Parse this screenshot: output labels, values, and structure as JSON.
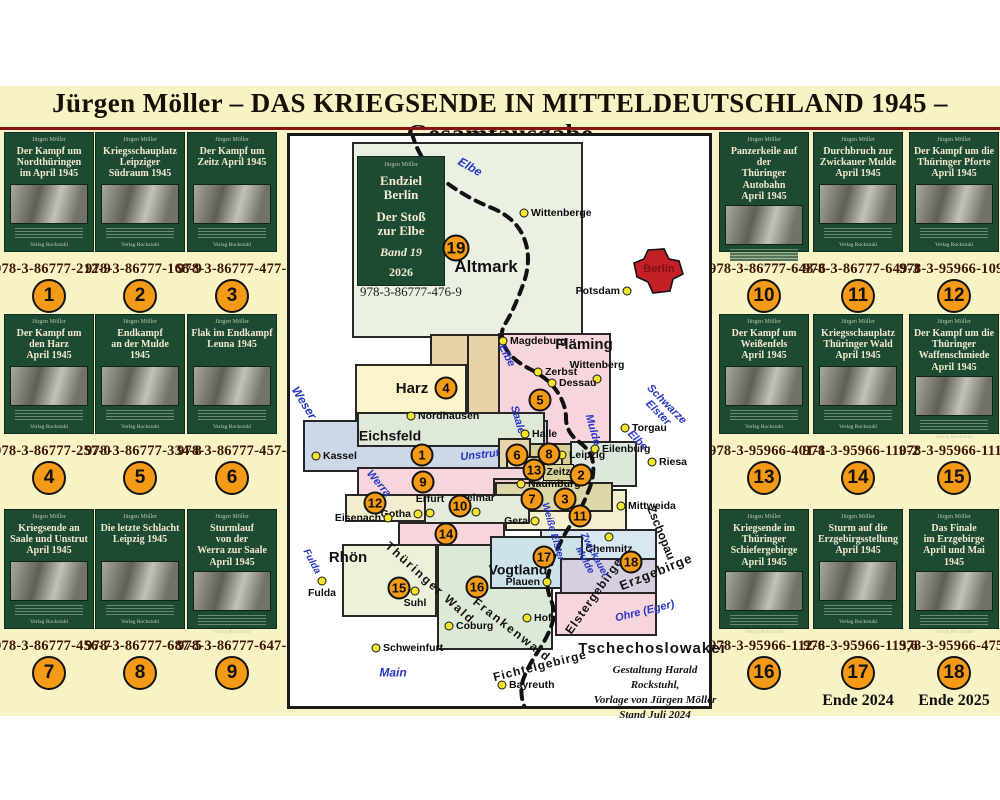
{
  "title": "Jürgen Möller – DAS KRIEGSENDE IN  MITTELDEUTSCHLAND 1945 – Gesamtausgabe",
  "author": "Jürgen Möller",
  "publisher": "Verlag Rockstuhl",
  "books_left": [
    {
      "num": "1",
      "title": "Der Kampf um\nNordthüringen\nim April 1945",
      "isbn": "978-3-86777-212-9"
    },
    {
      "num": "2",
      "title": "Kriegsschauplatz\nLeipziger\nSüdraum 1945",
      "isbn": "978-3-86777-168-9"
    },
    {
      "num": "3",
      "title": "Der Kampf um\nZeitz April 1945",
      "isbn": "978-3-86777-477-2"
    },
    {
      "num": "4",
      "title": "Der Kampf um\nden Harz\nApril 1945",
      "isbn": "978-3-86777-257-0"
    },
    {
      "num": "5",
      "title": "Endkampf\nan der Mulde\n1945",
      "isbn": "978-3-86777-334-8"
    },
    {
      "num": "6",
      "title": "Flak im Endkampf\nLeuna 1945",
      "isbn": "978-3-86777-457-4"
    },
    {
      "num": "7",
      "title": "Kriegsende an\nSaale und Unstrut\nApril 1945",
      "isbn": "978-3-86777-456-7"
    },
    {
      "num": "8",
      "title": "Die letzte Schlacht\nLeipzig 1945",
      "isbn": "978-3-86777-687-5"
    },
    {
      "num": "9",
      "title": "Sturmlauf\nvon der\nWerra zur Saale\nApril 1945",
      "isbn": "978-3-86777-647-9"
    }
  ],
  "books_right": [
    {
      "num": "10",
      "title": "Panzerkeile auf der\nThüringer Autobahn\nApril 1945",
      "isbn": "978-3-86777-648-6"
    },
    {
      "num": "11",
      "title": "Durchbruch zur\nZwickauer Mulde\nApril 1945",
      "isbn": "978-3-86777-649-3"
    },
    {
      "num": "12",
      "title": "Der Kampf um die\nThüringer Pforte\nApril 1945",
      "isbn": "978-3-95966-109-6"
    },
    {
      "num": "13",
      "title": "Der Kampf um\nWeißenfels\nApril 1945",
      "isbn": "978-3-95966-401-1"
    },
    {
      "num": "14",
      "title": "Kriegsschauplatz\nThüringer Wald\nApril 1945",
      "isbn": "978-3-95966-110-2"
    },
    {
      "num": "15",
      "title": "Der Kampf um die\nThüringer\nWaffenschmiede\nApril 1945",
      "isbn": "978-3-95966-111-9"
    },
    {
      "num": "16",
      "title": "Kriegsende im\nThüringer Schiefergebirge\nApril 1945",
      "isbn": "978-3-95966-112-6"
    },
    {
      "num": "17",
      "title": "Sturm auf die\nErzgebirgsstellung\nApril 1945",
      "isbn": "978-3-95966-113,6",
      "note": "Ende 2024"
    },
    {
      "num": "18",
      "title": "Das Finale\nim Erzgebirge\nApril und Mai 1945",
      "isbn": "978-3-95966-475-2",
      "note": "Ende 2025"
    }
  ],
  "band19": {
    "num": "19",
    "author": "Jürgen Möller",
    "line1": "Endziel\nBerlin",
    "line2": "Der Stoß\nzur Elbe",
    "line3": "Band 19",
    "line4": "2026",
    "isbn": "978-3-86777-476-9"
  },
  "map": {
    "credit": "Gestaltung Harald Rockstuhl,\nVorlage von Jürgen Möller\nStand Juli 2024",
    "berlin_label": "Berlin",
    "zeitz_box": {
      "text": "Zeitz",
      "x": 543,
      "y": 464,
      "w": 31,
      "h": 17
    },
    "boxes": [
      [
        352,
        142,
        231,
        196,
        "#eaf0e2"
      ],
      [
        430,
        334,
        153,
        32,
        "#e9d2a8"
      ],
      [
        467,
        334,
        40,
        103,
        "#e9d2a8"
      ],
      [
        498,
        333,
        113,
        114,
        "#f7d5dc"
      ],
      [
        355,
        364,
        112,
        73,
        "#fcf5cc"
      ],
      [
        303,
        420,
        245,
        52,
        "#ccd8e8"
      ],
      [
        357,
        412,
        188,
        35,
        "#dfe9d8"
      ],
      [
        528,
        443,
        84,
        44,
        "#d6d096"
      ],
      [
        570,
        441,
        67,
        46,
        "#dce8dc"
      ],
      [
        498,
        438,
        33,
        52,
        "#e6d5ac"
      ],
      [
        506,
        456,
        57,
        32,
        "#e9ddb9"
      ],
      [
        357,
        467,
        173,
        31,
        "#f7d5dc"
      ],
      [
        505,
        489,
        122,
        42,
        "#f4efcf"
      ],
      [
        493,
        478,
        40,
        34,
        "#f0c9cd"
      ],
      [
        495,
        482,
        118,
        30,
        "#ddd6a8"
      ],
      [
        345,
        494,
        87,
        28,
        "#f2edcf"
      ],
      [
        424,
        494,
        106,
        30,
        "#e3ecdb"
      ],
      [
        398,
        522,
        107,
        29,
        "#f7d5dc"
      ],
      [
        342,
        544,
        95,
        73,
        "#ecf2da"
      ],
      [
        437,
        544,
        116,
        106,
        "#dbe9d6"
      ],
      [
        540,
        529,
        117,
        31,
        "#d8e8f2"
      ],
      [
        490,
        536,
        93,
        53,
        "#cee2e9"
      ],
      [
        560,
        558,
        97,
        36,
        "#d5cfe1"
      ],
      [
        555,
        592,
        102,
        44,
        "#f7d5dc"
      ]
    ],
    "labels": [
      {
        "t": "Altmark",
        "x": 486,
        "y": 267,
        "s": 17,
        "r": 0
      },
      {
        "t": "Fläming",
        "x": 584,
        "y": 345,
        "s": 15,
        "r": 0
      },
      {
        "t": "Harz",
        "x": 412,
        "y": 389,
        "s": 15,
        "r": 0
      },
      {
        "t": "Eichsfeld",
        "x": 390,
        "y": 436,
        "s": 14,
        "r": 0
      },
      {
        "t": "Rhön",
        "x": 348,
        "y": 558,
        "s": 15,
        "r": 0
      },
      {
        "t": "Vogtland",
        "x": 518,
        "y": 570,
        "s": 14,
        "r": 0
      },
      {
        "t": "Thüringer Wald",
        "x": 430,
        "y": 583,
        "s": 12,
        "r": 42,
        "ls": 2
      },
      {
        "t": "Frankenwald",
        "x": 512,
        "y": 630,
        "s": 12,
        "r": 38,
        "ls": 2
      },
      {
        "t": "Fichtelgebirge",
        "x": 540,
        "y": 666,
        "s": 12,
        "r": -14,
        "ls": 1
      },
      {
        "t": "Elstergebirge",
        "x": 594,
        "y": 596,
        "s": 12,
        "r": -55,
        "ls": 1
      },
      {
        "t": "Erzgebirge",
        "x": 656,
        "y": 572,
        "s": 13,
        "r": -22,
        "ls": 1
      },
      {
        "t": "Zschopau",
        "x": 661,
        "y": 533,
        "s": 12,
        "r": 68
      },
      {
        "t": "Tschechoslowakei",
        "x": 652,
        "y": 649,
        "s": 15,
        "r": 0,
        "ls": 1
      }
    ],
    "rivers": [
      {
        "t": "Elbe",
        "x": 470,
        "y": 167,
        "s": 12,
        "r": 30
      },
      {
        "t": "Elbe",
        "x": 506,
        "y": 356,
        "s": 11,
        "r": 62
      },
      {
        "t": "Elbe",
        "x": 637,
        "y": 441,
        "s": 11,
        "r": 45
      },
      {
        "t": "Weser",
        "x": 304,
        "y": 403,
        "s": 12,
        "r": 58
      },
      {
        "t": "Saale",
        "x": 517,
        "y": 420,
        "s": 11,
        "r": 74
      },
      {
        "t": "Unstrut",
        "x": 480,
        "y": 456,
        "s": 11,
        "r": -6
      },
      {
        "t": "Werra",
        "x": 378,
        "y": 484,
        "s": 11,
        "r": 50
      },
      {
        "t": "Mulde",
        "x": 592,
        "y": 430,
        "s": 11,
        "r": 74
      },
      {
        "t": "Schwarze\nElster",
        "x": 662,
        "y": 409,
        "s": 11,
        "r": 45
      },
      {
        "t": "Weiße Elster",
        "x": 552,
        "y": 532,
        "s": 10,
        "r": 74
      },
      {
        "t": "Zwickauer\nMulde",
        "x": 589,
        "y": 558,
        "s": 10,
        "r": 62
      },
      {
        "t": "Ohre (Eger)",
        "x": 645,
        "y": 612,
        "s": 11,
        "r": -14
      },
      {
        "t": "Main",
        "x": 393,
        "y": 673,
        "s": 12,
        "r": 0
      },
      {
        "t": "Fulda",
        "x": 311,
        "y": 562,
        "s": 10,
        "r": 62
      }
    ],
    "cities": [
      {
        "n": "Wittenberge",
        "x": 524,
        "y": 213,
        "side": "right"
      },
      {
        "n": "Potsdam",
        "x": 627,
        "y": 291,
        "side": "left"
      },
      {
        "n": "Magdeburg",
        "x": 503,
        "y": 341,
        "side": "right"
      },
      {
        "n": "Zerbst",
        "x": 538,
        "y": 372,
        "side": "right"
      },
      {
        "n": "Wittenberg",
        "x": 597,
        "y": 379,
        "side": "above"
      },
      {
        "n": "Dessau",
        "x": 552,
        "y": 383,
        "side": "right"
      },
      {
        "n": "Nordhausen",
        "x": 411,
        "y": 416,
        "side": "right"
      },
      {
        "n": "Halle",
        "x": 525,
        "y": 434,
        "side": "right"
      },
      {
        "n": "Kassel",
        "x": 316,
        "y": 456,
        "side": "right"
      },
      {
        "n": "Torgau",
        "x": 625,
        "y": 428,
        "side": "right"
      },
      {
        "n": "Eilenburg",
        "x": 595,
        "y": 449,
        "side": "right"
      },
      {
        "n": "Riesa",
        "x": 652,
        "y": 462,
        "side": "right"
      },
      {
        "n": "Leipzig",
        "x": 562,
        "y": 455,
        "side": "right"
      },
      {
        "n": "Naumburg",
        "x": 521,
        "y": 484,
        "side": "right"
      },
      {
        "n": "Weimar",
        "x": 476,
        "y": 512,
        "side": "above"
      },
      {
        "n": "Erfurt",
        "x": 430,
        "y": 513,
        "side": "above"
      },
      {
        "n": "Gotha",
        "x": 418,
        "y": 514,
        "side": "left"
      },
      {
        "n": "Eisenach",
        "x": 388,
        "y": 518,
        "side": "left"
      },
      {
        "n": "Gera",
        "x": 535,
        "y": 521,
        "side": "left"
      },
      {
        "n": "Mittweida",
        "x": 621,
        "y": 506,
        "side": "right"
      },
      {
        "n": "Chemnitz",
        "x": 609,
        "y": 537,
        "side": "below"
      },
      {
        "n": "Plauen",
        "x": 547,
        "y": 582,
        "side": "left"
      },
      {
        "n": "Suhl",
        "x": 415,
        "y": 591,
        "side": "below"
      },
      {
        "n": "Hof",
        "x": 527,
        "y": 618,
        "side": "right"
      },
      {
        "n": "Coburg",
        "x": 449,
        "y": 626,
        "side": "right"
      },
      {
        "n": "Schweinfurt",
        "x": 376,
        "y": 648,
        "side": "right"
      },
      {
        "n": "Fulda",
        "x": 322,
        "y": 581,
        "side": "below"
      },
      {
        "n": "Bayreuth",
        "x": 502,
        "y": 685,
        "side": "right"
      }
    ],
    "markers": [
      {
        "n": "1",
        "x": 422,
        "y": 455
      },
      {
        "n": "2",
        "x": 581,
        "y": 475
      },
      {
        "n": "3",
        "x": 565,
        "y": 499
      },
      {
        "n": "4",
        "x": 446,
        "y": 388
      },
      {
        "n": "5",
        "x": 540,
        "y": 400
      },
      {
        "n": "6",
        "x": 517,
        "y": 455
      },
      {
        "n": "7",
        "x": 532,
        "y": 499
      },
      {
        "n": "8",
        "x": 549,
        "y": 454
      },
      {
        "n": "9",
        "x": 423,
        "y": 482
      },
      {
        "n": "10",
        "x": 460,
        "y": 506
      },
      {
        "n": "11",
        "x": 580,
        "y": 516
      },
      {
        "n": "12",
        "x": 375,
        "y": 503
      },
      {
        "n": "13",
        "x": 534,
        "y": 470
      },
      {
        "n": "14",
        "x": 446,
        "y": 534
      },
      {
        "n": "15",
        "x": 399,
        "y": 588
      },
      {
        "n": "16",
        "x": 477,
        "y": 587
      },
      {
        "n": "17",
        "x": 544,
        "y": 557
      },
      {
        "n": "18",
        "x": 631,
        "y": 562
      },
      {
        "n": "19",
        "x": 456,
        "y": 248,
        "d": 27
      }
    ]
  }
}
